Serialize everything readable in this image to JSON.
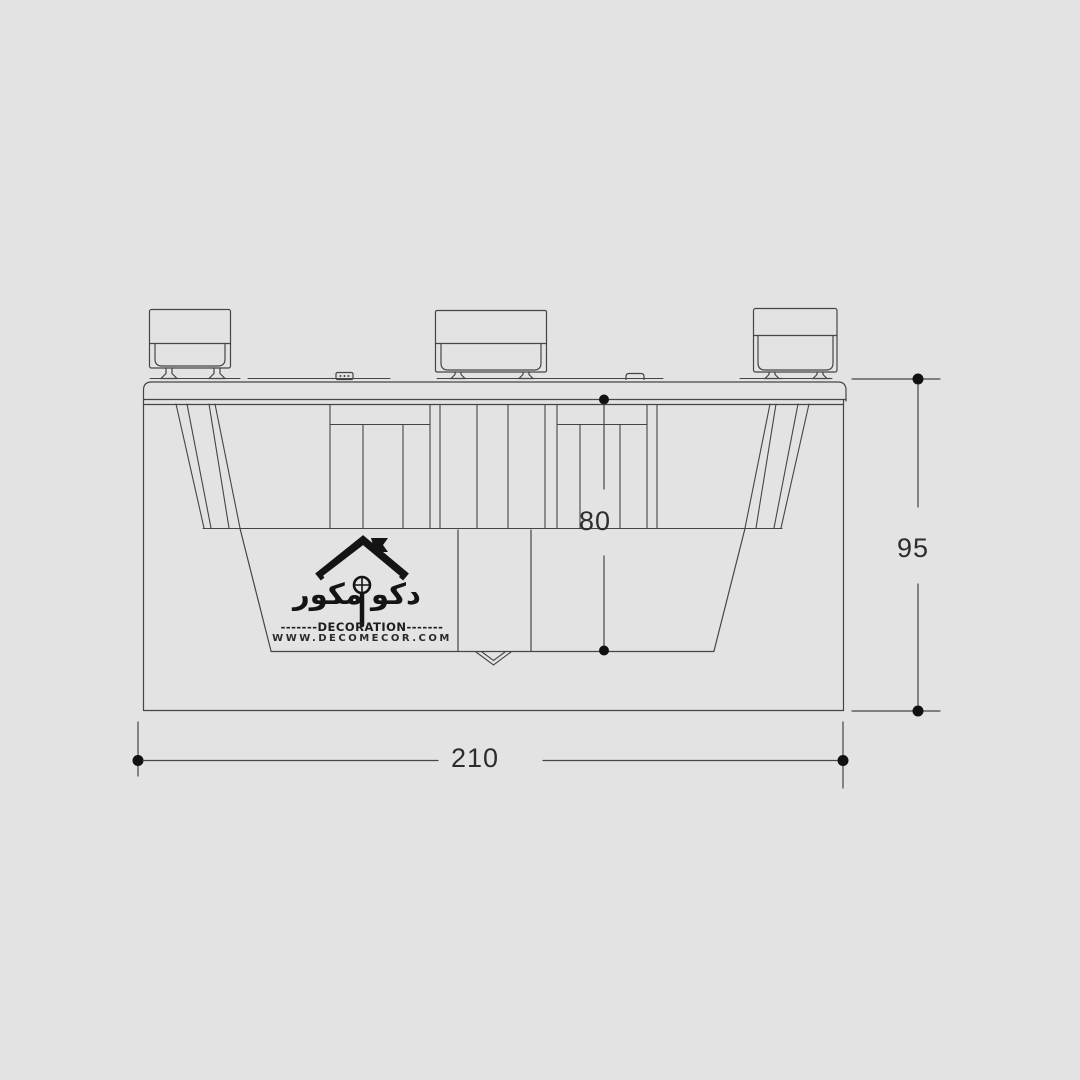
{
  "canvas": {
    "background": "#e3e3e3",
    "line_color": "#454545",
    "dot_color": "#111111",
    "text_color": "#2d2d2d"
  },
  "dimensions": {
    "overall_width": {
      "value": "210"
    },
    "overall_height": {
      "value": "95"
    },
    "recess_depth": {
      "value": "80"
    }
  },
  "logo": {
    "brand_arabic_right": "دکو",
    "brand_arabic_left": "مکور",
    "decoration_label": "-------DECORATION-------",
    "website": "WWW.DECOMECOR.COM"
  }
}
